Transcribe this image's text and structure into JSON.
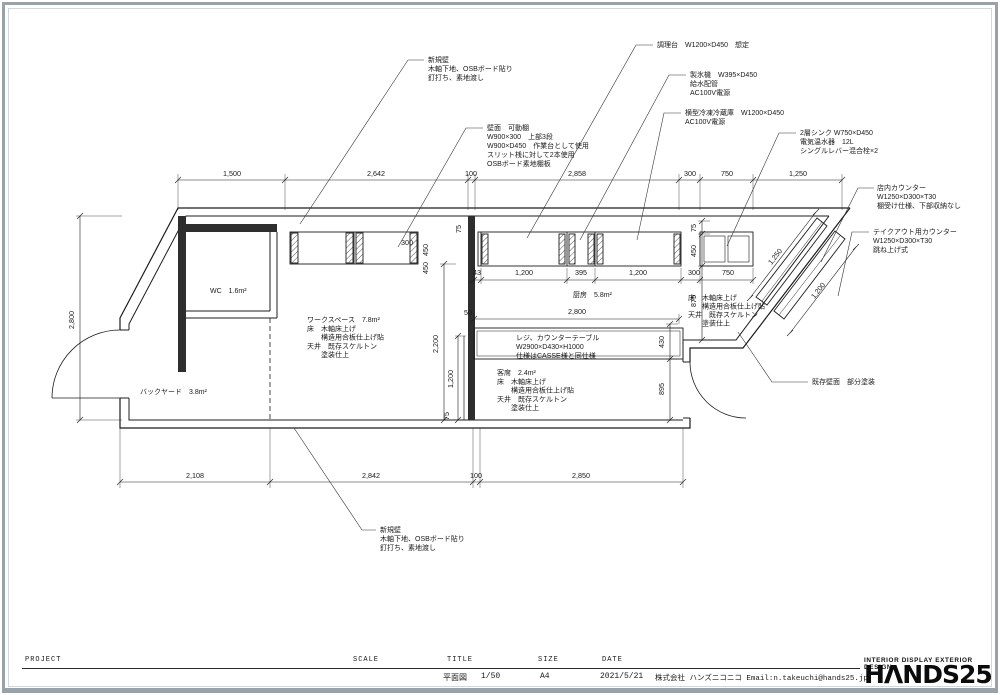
{
  "page": {
    "line_color": "#1c1c1c",
    "frame_color": "#9aa2a9",
    "wall_fill": "#2e2e2e"
  },
  "title_block": {
    "project_label": "PROJECT",
    "scale_label": "SCALE",
    "title_label": "TITLE",
    "size_label": "SIZE",
    "date_label": "DATE",
    "title_value": "平面図",
    "scale_value": "1/50",
    "size_value": "A4",
    "date_value": "2021/5/21",
    "company": "株式会社 ハンズニコニコ Email:n.takeuchi@hands25.jp",
    "brand_tagline": "INTERIOR DISPLAY EXTERIOR DESIGN",
    "brand_logo": "HΛNDS25"
  },
  "drawing": {
    "annotations": [
      {
        "name": "note-new-wall-top",
        "x": 428,
        "y": 62,
        "lh": 9,
        "lines": [
          "新規壁",
          "木軸下地、OSBボード貼り",
          "釘打ち、素地渡し"
        ],
        "leader": "300,224 408,60 424,60"
      },
      {
        "name": "note-wall-shelf",
        "x": 487,
        "y": 130,
        "lh": 9,
        "lines": [
          "壁面　可動棚",
          "W900×300　上部3段",
          "W900×D450　作業台として使用",
          "スリット桟に対して2本使用",
          "OSBボード素地棚板"
        ],
        "leader": "398,247 466,128 483,128"
      },
      {
        "name": "note-cooktop",
        "x": 657,
        "y": 47,
        "lh": 9,
        "lines": [
          "調理台　W1200×D450　想定"
        ],
        "leader": "527,238 636,45 653,45"
      },
      {
        "name": "note-ice-maker",
        "x": 690,
        "y": 77,
        "lh": 9,
        "lines": [
          "製氷機　W395×D450",
          "給水配管",
          "AC100V電源"
        ],
        "leader": "580,240 669,75 686,75"
      },
      {
        "name": "note-freezer",
        "x": 685,
        "y": 115,
        "lh": 9,
        "lines": [
          "横型冷凍冷蔵庫　W1200×D450",
          "AC100V電源"
        ],
        "leader": "637,240 664,113 681,113"
      },
      {
        "name": "note-sink",
        "x": 800,
        "y": 135,
        "lh": 9,
        "lines": [
          "2層シンク W750×D450",
          "電気温水器　12L",
          "シングルレバー混合栓×2"
        ],
        "leader": "727,246 779,133 796,133"
      },
      {
        "name": "note-counter-store",
        "x": 877,
        "y": 190,
        "lh": 9,
        "lines": [
          "店内カウンター",
          "W1250×D300×T30",
          "棚受け仕様、下部収納なし"
        ],
        "leader": "821,262 858,188 874,188"
      },
      {
        "name": "note-counter-takeout",
        "x": 873,
        "y": 234,
        "lh": 9,
        "lines": [
          "テイクアウト用カウンター",
          "W1250×D300×T30",
          "跳ね上げ式"
        ],
        "leader": "838,296 852,232 869,232"
      },
      {
        "name": "note-existing-wall",
        "x": 812,
        "y": 384,
        "lh": 9,
        "lines": [
          "既存壁面　部分塗装"
        ],
        "leader": "738,332 772,382 808,382"
      },
      {
        "name": "note-new-wall-bottom",
        "x": 380,
        "y": 532,
        "lh": 9,
        "lines": [
          "新規壁",
          "木軸下地、OSBボード貼り",
          "釘打ち、素地渡し"
        ],
        "leader": "294,428 362,530 376,530"
      },
      {
        "name": "room-wc",
        "x": 210,
        "y": 293,
        "lh": 9,
        "lines": [
          "WC　1.6m²"
        ]
      },
      {
        "name": "room-backyard",
        "x": 140,
        "y": 394,
        "lh": 9,
        "lines": [
          "バックヤード　3.8m²"
        ]
      },
      {
        "name": "room-kitchen",
        "x": 573,
        "y": 297,
        "lh": 9,
        "lines": [
          "厨房　5.8m²"
        ]
      },
      {
        "name": "room-workspace",
        "x": 307,
        "y": 322,
        "lh": 8.8,
        "lines": [
          "ワークスペース　7.8m²",
          "床　木軸床上げ",
          "　　構造用合板仕上げ貼",
          "天井　既存スケルトン",
          "　　塗装仕上"
        ]
      },
      {
        "name": "room-register-counter",
        "x": 516,
        "y": 340,
        "lh": 9,
        "lines": [
          "レジ、カウンターテーブル",
          "W2900×D430×H1000",
          "仕様はCASSE様と同仕様"
        ]
      },
      {
        "name": "room-seating",
        "x": 497,
        "y": 375,
        "lh": 8.8,
        "lines": [
          "客席　2.4m²",
          "床　木軸床上げ",
          "　　構造用合板仕上げ貼",
          "天井　既存スケルトン",
          "　　塗装仕上"
        ]
      },
      {
        "name": "spec-floor-right",
        "x": 688,
        "y": 300,
        "lh": 8.5,
        "lines": [
          "床　木軸床上げ",
          "　　構造用合板仕上げ貼",
          "天井　既存スケルトン",
          "　　塗装仕上"
        ]
      }
    ],
    "dims": [
      {
        "t": "1,500",
        "x": 232,
        "y": 176
      },
      {
        "t": "2,642",
        "x": 376,
        "y": 176
      },
      {
        "t": "100",
        "x": 471,
        "y": 176
      },
      {
        "t": "2,858",
        "x": 577,
        "y": 176
      },
      {
        "t": "300",
        "x": 690,
        "y": 176
      },
      {
        "t": "750",
        "x": 727,
        "y": 176
      },
      {
        "t": "1,250",
        "x": 798,
        "y": 176
      },
      {
        "t": "2,108",
        "x": 195,
        "y": 478
      },
      {
        "t": "2,842",
        "x": 371,
        "y": 478
      },
      {
        "t": "100",
        "x": 476,
        "y": 478
      },
      {
        "t": "2,850",
        "x": 581,
        "y": 478
      },
      {
        "t": "2,800",
        "x": 74,
        "y": 320,
        "r": -90
      },
      {
        "t": "300",
        "x": 407,
        "y": 245
      },
      {
        "t": "450",
        "x": 428,
        "y": 250,
        "r": -90
      },
      {
        "t": "450",
        "x": 428,
        "y": 268,
        "r": -90
      },
      {
        "t": "75",
        "x": 461,
        "y": 229,
        "r": -90
      },
      {
        "t": "2,200",
        "x": 438,
        "y": 344,
        "r": -90
      },
      {
        "t": "1,200",
        "x": 453,
        "y": 379,
        "r": -90
      },
      {
        "t": "75",
        "x": 449,
        "y": 416,
        "r": -90
      },
      {
        "t": "43",
        "x": 477,
        "y": 275
      },
      {
        "t": "1,200",
        "x": 524,
        "y": 275
      },
      {
        "t": "395",
        "x": 581,
        "y": 275
      },
      {
        "t": "1,200",
        "x": 638,
        "y": 275
      },
      {
        "t": "300",
        "x": 694,
        "y": 275
      },
      {
        "t": "750",
        "x": 728,
        "y": 275
      },
      {
        "t": "50",
        "x": 468,
        "y": 315
      },
      {
        "t": "2,800",
        "x": 577,
        "y": 314
      },
      {
        "t": "75",
        "x": 696,
        "y": 228,
        "r": -90
      },
      {
        "t": "450",
        "x": 696,
        "y": 251,
        "r": -90
      },
      {
        "t": "875",
        "x": 696,
        "y": 301,
        "r": -90
      },
      {
        "t": "430",
        "x": 664,
        "y": 342,
        "r": -90
      },
      {
        "t": "895",
        "x": 664,
        "y": 389,
        "r": -90
      },
      {
        "t": "1,250",
        "x": 777,
        "y": 258,
        "r": -52
      },
      {
        "t": "1,200",
        "x": 820,
        "y": 292,
        "r": -52
      }
    ]
  }
}
